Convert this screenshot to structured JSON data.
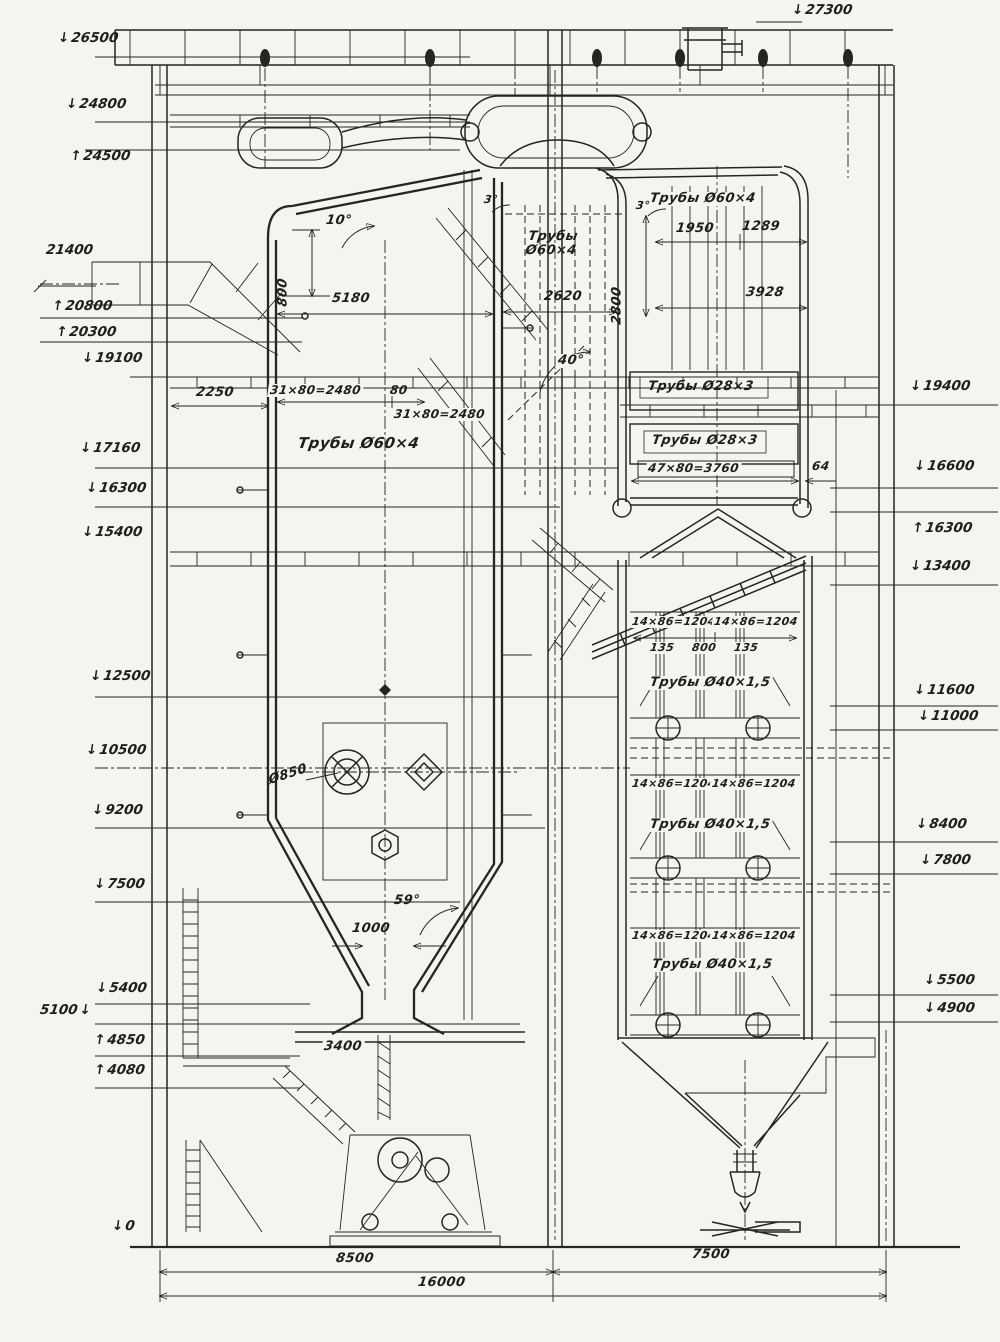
{
  "meta": {
    "kind": "scanned technical drawing",
    "subject": "Paroviy kotyol — prodolny razrez (boiler sectional elevation)",
    "language": "ru"
  },
  "colors": {
    "paper": "#f5f4f0",
    "ink": "#26251f"
  },
  "elevation_marks_left": [
    {
      "value": "26500",
      "dir": "down"
    },
    {
      "value": "24800",
      "dir": "down"
    },
    {
      "value": "24500",
      "dir": "up"
    },
    {
      "value": "21400",
      "dir": "none"
    },
    {
      "value": "20800",
      "dir": "up"
    },
    {
      "value": "20300",
      "dir": "up"
    },
    {
      "value": "19100",
      "dir": "down"
    },
    {
      "value": "17160",
      "dir": "down"
    },
    {
      "value": "16300",
      "dir": "down"
    },
    {
      "value": "15400",
      "dir": "down"
    },
    {
      "value": "12500",
      "dir": "down"
    },
    {
      "value": "10500",
      "dir": "down"
    },
    {
      "value": "9200",
      "dir": "down"
    },
    {
      "value": "7500",
      "dir": "down"
    },
    {
      "value": "5400",
      "dir": "down"
    },
    {
      "value": "5100",
      "dir": "down"
    },
    {
      "value": "4850",
      "dir": "up"
    },
    {
      "value": "4080",
      "dir": "up"
    },
    {
      "value": "0",
      "dir": "down"
    }
  ],
  "elevation_marks_right": [
    {
      "value": "27300",
      "dir": "down"
    },
    {
      "value": "19400",
      "dir": "down"
    },
    {
      "value": "16600",
      "dir": "down"
    },
    {
      "value": "16300",
      "dir": "up"
    },
    {
      "value": "13400",
      "dir": "down"
    },
    {
      "value": "11600",
      "dir": "down"
    },
    {
      "value": "11000",
      "dir": "down"
    },
    {
      "value": "8400",
      "dir": "down"
    },
    {
      "value": "7800",
      "dir": "down"
    },
    {
      "value": "5500",
      "dir": "down"
    },
    {
      "value": "4900",
      "dir": "down"
    }
  ],
  "pipe_labels": {
    "furnace_wall": "Трубы Ø60×4",
    "center_pass_line1": "Трубы",
    "center_pass_line2": "Ø60×4",
    "rear_shaft_top": "Трубы Ø60×4",
    "coil_upper": "Трубы Ø28×3",
    "coil_lower": "Трубы Ø28×3",
    "economizer": "Трубы Ø40×1,5"
  },
  "dimensions": {
    "roof_offset": "800",
    "furnace_width": "5180",
    "center_pass_width": "2620",
    "rear_pass_height": "2800",
    "rear_span_a": "1950",
    "rear_span_b": "1289",
    "rear_width": "3928",
    "duct_offset": "2250",
    "tube_pitch_a": "31×80=2480",
    "tube_gap": "80",
    "tube_pitch_b": "31×80=2480",
    "coil_pitch": "47×80=3760",
    "wall_gap": "64",
    "econ_pitch": "14×86=1204",
    "econ_gap_a": "135",
    "econ_gap_mid": "800",
    "econ_gap_b": "135",
    "throat_width": "1000",
    "slag_width": "3400",
    "burner_dia": "Ø850",
    "bay_left": "8500",
    "bay_right": "7500",
    "total_width": "16000"
  },
  "angles": {
    "roof": "10°",
    "slope_left": "3°",
    "slope_right": "3°",
    "stair": "40°",
    "funnel": "59°"
  }
}
